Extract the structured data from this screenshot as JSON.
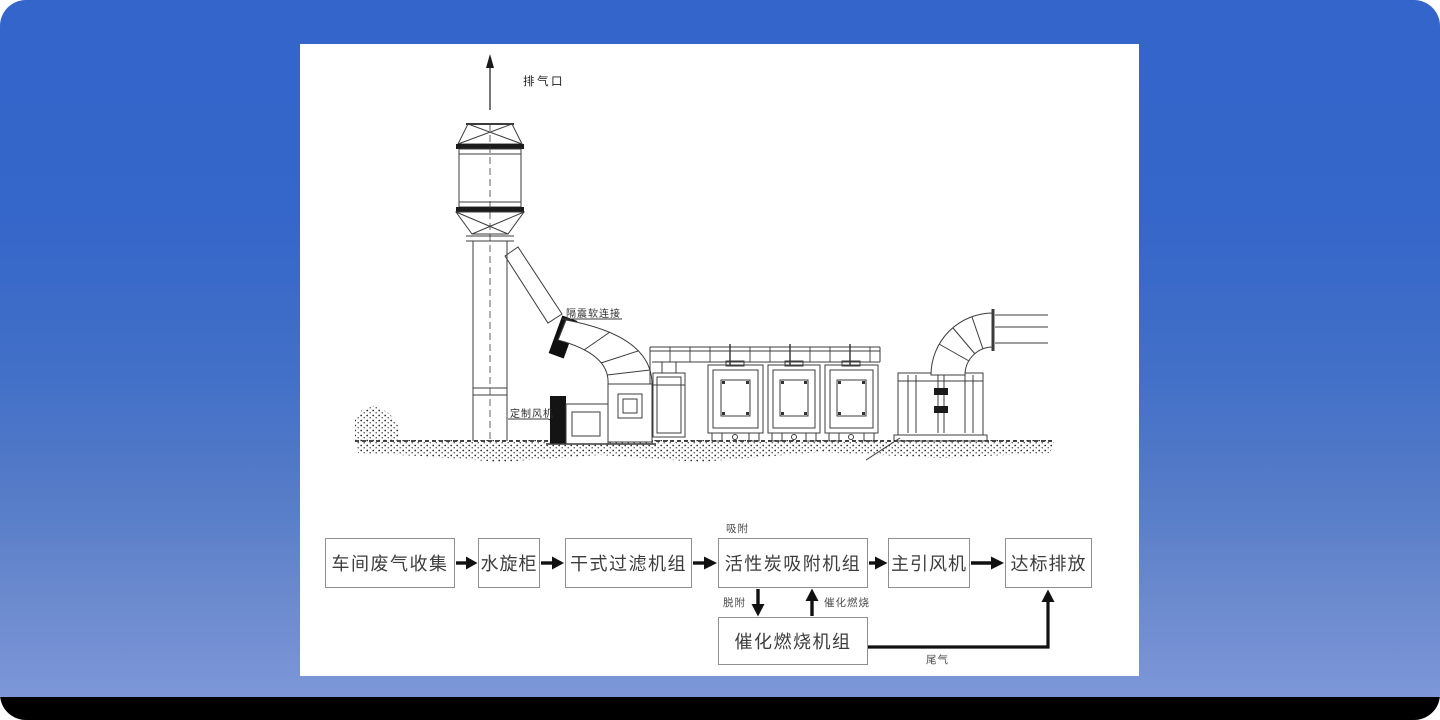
{
  "drawing": {
    "labels": {
      "exhaust_outlet": "排气口",
      "flex_connection": "隔震软连接",
      "custom_fan": "定制风机"
    },
    "colors": {
      "line": "#3c3c3c",
      "dark_fill": "#161616",
      "panel": "#ffffff"
    }
  },
  "flowchart": {
    "boxes": [
      {
        "id": "workshop-exhaust-collection",
        "label": "车间废气收集"
      },
      {
        "id": "water-spray-cabinet",
        "label": "水旋柜"
      },
      {
        "id": "dry-filter-unit",
        "label": "干式过滤机组"
      },
      {
        "id": "activated-carbon-adsorption-unit",
        "label": "活性炭吸附机组"
      },
      {
        "id": "main-draft-fan",
        "label": "主引风机"
      },
      {
        "id": "compliant-discharge",
        "label": "达标排放"
      },
      {
        "id": "catalytic-combustion-unit",
        "label": "催化燃烧机组"
      }
    ],
    "labels": {
      "adsorption": "吸附",
      "desorption": "脱附",
      "catalytic_combustion": "催化燃烧",
      "tail_gas": "尾气"
    },
    "edges": [
      {
        "from": "车间废气收集",
        "to": "水旋柜"
      },
      {
        "from": "水旋柜",
        "to": "干式过滤机组"
      },
      {
        "from": "干式过滤机组",
        "to": "活性炭吸附机组"
      },
      {
        "from": "活性炭吸附机组",
        "to": "主引风机"
      },
      {
        "from": "主引风机",
        "to": "达标排放"
      },
      {
        "from": "活性炭吸附机组",
        "to": "催化燃烧机组",
        "label": "脱附"
      },
      {
        "from": "催化燃烧机组",
        "to": "活性炭吸附机组",
        "label": "催化燃烧"
      },
      {
        "from": "催化燃烧机组",
        "to": "达标排放",
        "label": "尾气"
      }
    ]
  },
  "background": {
    "top": "#3365cb",
    "bottom": "#7e98d8",
    "bottom_bar": "#000000"
  }
}
